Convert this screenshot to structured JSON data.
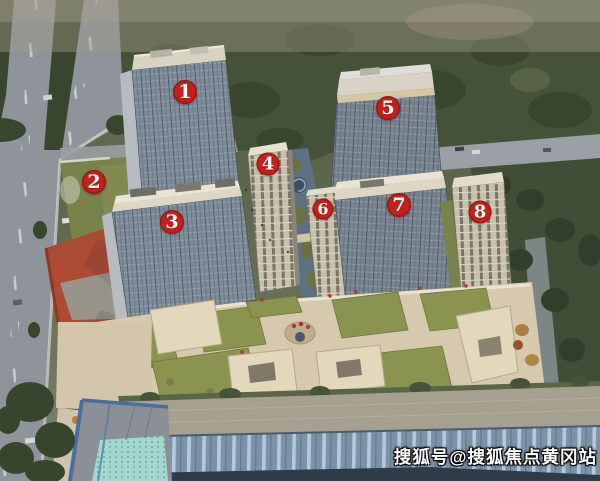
{
  "markers": {
    "color": "#c4211d",
    "text_color": "#ffffff",
    "items": [
      {
        "label": "1",
        "x": 185,
        "y": 92,
        "d": 24
      },
      {
        "label": "2",
        "x": 94,
        "y": 182,
        "d": 24
      },
      {
        "label": "3",
        "x": 172,
        "y": 222,
        "d": 24
      },
      {
        "label": "4",
        "x": 268,
        "y": 164,
        "d": 23
      },
      {
        "label": "5",
        "x": 388,
        "y": 108,
        "d": 24
      },
      {
        "label": "6",
        "x": 323,
        "y": 209,
        "d": 21
      },
      {
        "label": "7",
        "x": 399,
        "y": 205,
        "d": 24
      },
      {
        "label": "8",
        "x": 480,
        "y": 212,
        "d": 23
      }
    ]
  },
  "watermark": {
    "text": "搜狐号@搜狐焦点黄冈站",
    "color": "#ffffff"
  }
}
